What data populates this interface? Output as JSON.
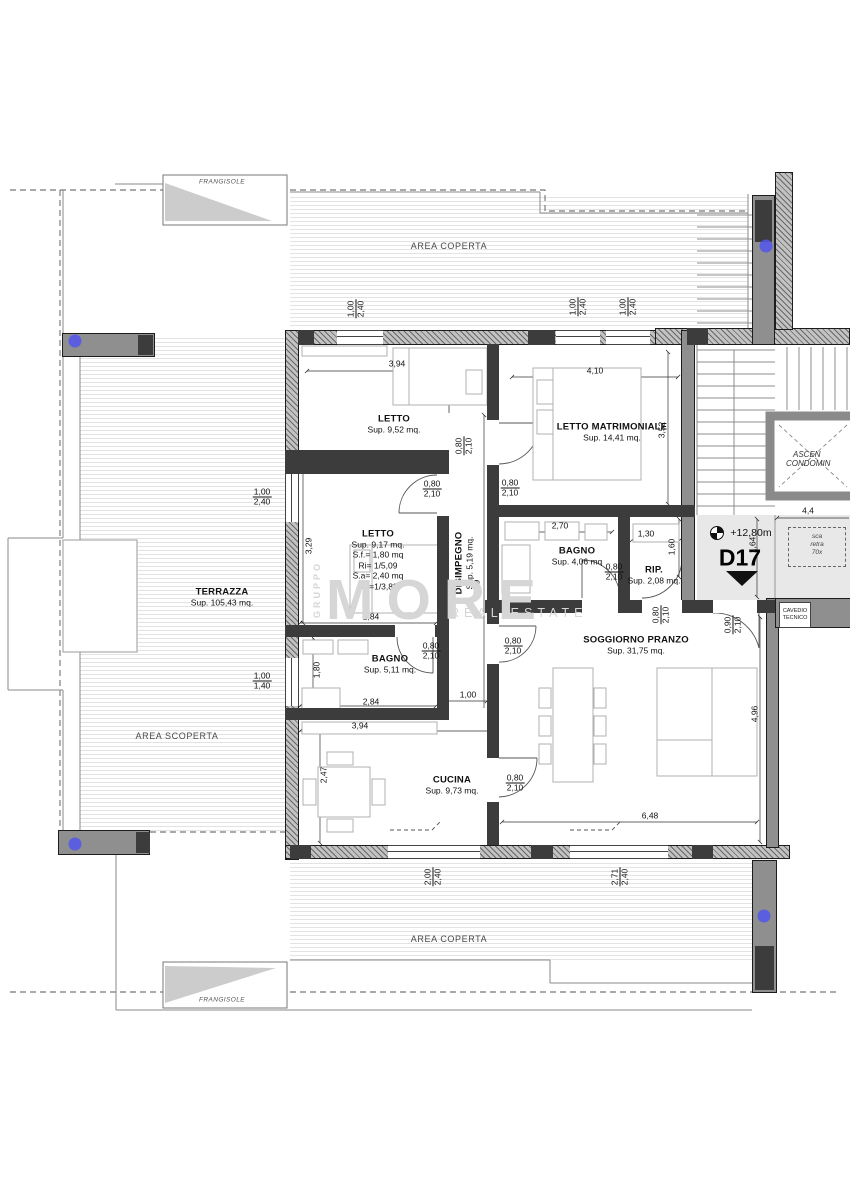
{
  "rooms": {
    "letto1": {
      "name": "LETTO",
      "sup": "Sup. 9,52 mq."
    },
    "letto_matrimoniale": {
      "name": "LETTO MATRIMONIALE",
      "sup": "Sup. 14,41 mq."
    },
    "letto2": {
      "name": "LETTO",
      "sup": "Sup. 9,17 mq.",
      "extra1": "S.f.= 1,80 mq",
      "extra2": "Ri= 1/5,09",
      "extra3": "S.a= 2,40 mq",
      "extra4": "Ra=1/3,82"
    },
    "disimpegno": {
      "name": "DISIMPEGNO",
      "sup": "Sup. 5,19 mq."
    },
    "bagno_notte": {
      "name": "BAGNO",
      "sup": "Sup. 4,06 mq"
    },
    "rip": {
      "name": "RIP.",
      "sup": "Sup. 2,08 mq."
    },
    "bagno_giorno": {
      "name": "BAGNO",
      "sup": "Sup. 5,11 mq."
    },
    "cucina": {
      "name": "CUCINA",
      "sup": "Sup. 9,73 mq."
    },
    "soggiorno": {
      "name": "SOGGIORNO PRANZO",
      "sup": "Sup. 31,75 mq."
    },
    "terrazza": {
      "name": "TERRAZZA",
      "sup": "Sup. 105,43 mq."
    }
  },
  "areas": {
    "coperta_top": "AREA COPERTA",
    "coperta_bottom": "AREA COPERTA",
    "scoperta": "AREA SCOPERTA",
    "frangisole_top": "FRANGISOLE",
    "frangisole_bottom": "FRANGISOLE"
  },
  "unit": {
    "code": "D17",
    "level": "+12,80m"
  },
  "stairwell": {
    "elevator_line1": "ASCEN",
    "elevator_line2": "CONDOMIN",
    "cavedio_line1": "CAVEDIO",
    "cavedio_line2": "TECNICO",
    "ladder_line1": "sca",
    "ladder_line2": "retra",
    "ladder_line3": "70x"
  },
  "watermark": {
    "side": "GRUPPO",
    "main": "MORE",
    "sub": "REAL ESTATE"
  },
  "markers": {
    "color": "#5456ee",
    "positions": [
      {
        "x": 75,
        "y": 341
      },
      {
        "x": 766,
        "y": 246
      },
      {
        "x": 75,
        "y": 844
      },
      {
        "x": 764,
        "y": 916
      }
    ]
  },
  "colors": {
    "wall_dark": "#3c3c3c",
    "wall_gray": "#8f8f8f",
    "landing_bg": "#e8e8e8",
    "marker_blue": "#5456ee",
    "watermark_gray": "#d6d6d6"
  },
  "dims": [
    {
      "num": "1,00",
      "den": "2,40",
      "x": 356,
      "y": 309,
      "r": 90
    },
    {
      "num": "1,00",
      "den": "2,40",
      "x": 578,
      "y": 307,
      "r": 90
    },
    {
      "num": "1,00",
      "den": "2,40",
      "x": 628,
      "y": 307,
      "r": 90
    },
    {
      "v": "3,94",
      "x": 397,
      "y": 364
    },
    {
      "v": "4,10",
      "x": 595,
      "y": 371
    },
    {
      "v": "3,52",
      "x": 662,
      "y": 430,
      "r": 90
    },
    {
      "num": "0,80",
      "den": "2,10",
      "x": 464,
      "y": 446,
      "r": 90
    },
    {
      "num": "0,80",
      "den": "2,10",
      "x": 432,
      "y": 489
    },
    {
      "num": "0,80",
      "den": "2,10",
      "x": 510,
      "y": 488
    },
    {
      "v": "2,70",
      "x": 560,
      "y": 526
    },
    {
      "v": "1,30",
      "x": 646,
      "y": 534
    },
    {
      "v": "1,60",
      "x": 672,
      "y": 547,
      "r": 90
    },
    {
      "num": "0,80",
      "den": "2,10",
      "x": 614,
      "y": 572
    },
    {
      "v": "3,29",
      "x": 309,
      "y": 546,
      "r": 90
    },
    {
      "num": "1,00",
      "den": "2,40",
      "x": 262,
      "y": 497
    },
    {
      "v": "2,84",
      "x": 371,
      "y": 617
    },
    {
      "v": "5,19",
      "x": 477,
      "y": 588,
      "r": 90
    },
    {
      "num": "0,80",
      "den": "2,10",
      "x": 431,
      "y": 651
    },
    {
      "v": "1,80",
      "x": 317,
      "y": 670,
      "r": 90
    },
    {
      "v": "2,84",
      "x": 371,
      "y": 702
    },
    {
      "v": "1,00",
      "x": 468,
      "y": 695
    },
    {
      "num": "0,80",
      "den": "2,10",
      "x": 513,
      "y": 646
    },
    {
      "num": "1,00",
      "den": "1,40",
      "x": 262,
      "y": 681
    },
    {
      "v": "3,94",
      "x": 360,
      "y": 726
    },
    {
      "v": "2,47",
      "x": 324,
      "y": 775,
      "r": 90
    },
    {
      "num": "0,80",
      "den": "2,10",
      "x": 515,
      "y": 783
    },
    {
      "num": "0,80",
      "den": "2,10",
      "x": 661,
      "y": 615,
      "r": 90
    },
    {
      "num": "0,90",
      "den": "2,10",
      "x": 733,
      "y": 625,
      "r": 90
    },
    {
      "v": "6,48",
      "x": 650,
      "y": 816
    },
    {
      "v": "4,96",
      "x": 755,
      "y": 714,
      "r": 90
    },
    {
      "num": "2,00",
      "den": "2,40",
      "x": 433,
      "y": 877,
      "r": 90
    },
    {
      "num": "2,71",
      "den": "2,40",
      "x": 620,
      "y": 877,
      "r": 90
    },
    {
      "v": "1,64",
      "x": 753,
      "y": 545,
      "r": 90
    },
    {
      "v": "4,4",
      "x": 808,
      "y": 511
    }
  ]
}
